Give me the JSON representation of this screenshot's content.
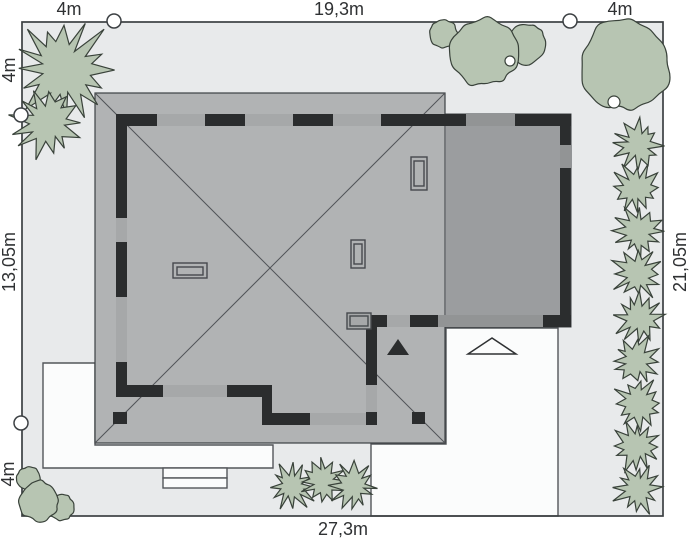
{
  "dimensions": {
    "top_left": "4m",
    "top_center": "19,3m",
    "top_right": "4m",
    "left_top": "4m",
    "left_middle": "13,05m",
    "left_bottom": "4m",
    "right_middle": "21,05m",
    "bottom_center": "27,3m"
  },
  "colors": {
    "plot_bg": "#e8eaeb",
    "roof": "#b1b3b4",
    "wing_roof": "#9b9d9f",
    "wall": "#2b2d2e",
    "window": "#a6a8a9",
    "wing_window": "#929495",
    "paving": "#fbfcfc",
    "tree": "#b7c5b2",
    "tree_outline": "#39423a",
    "outline": "#3c4043",
    "text": "#2f3133"
  }
}
